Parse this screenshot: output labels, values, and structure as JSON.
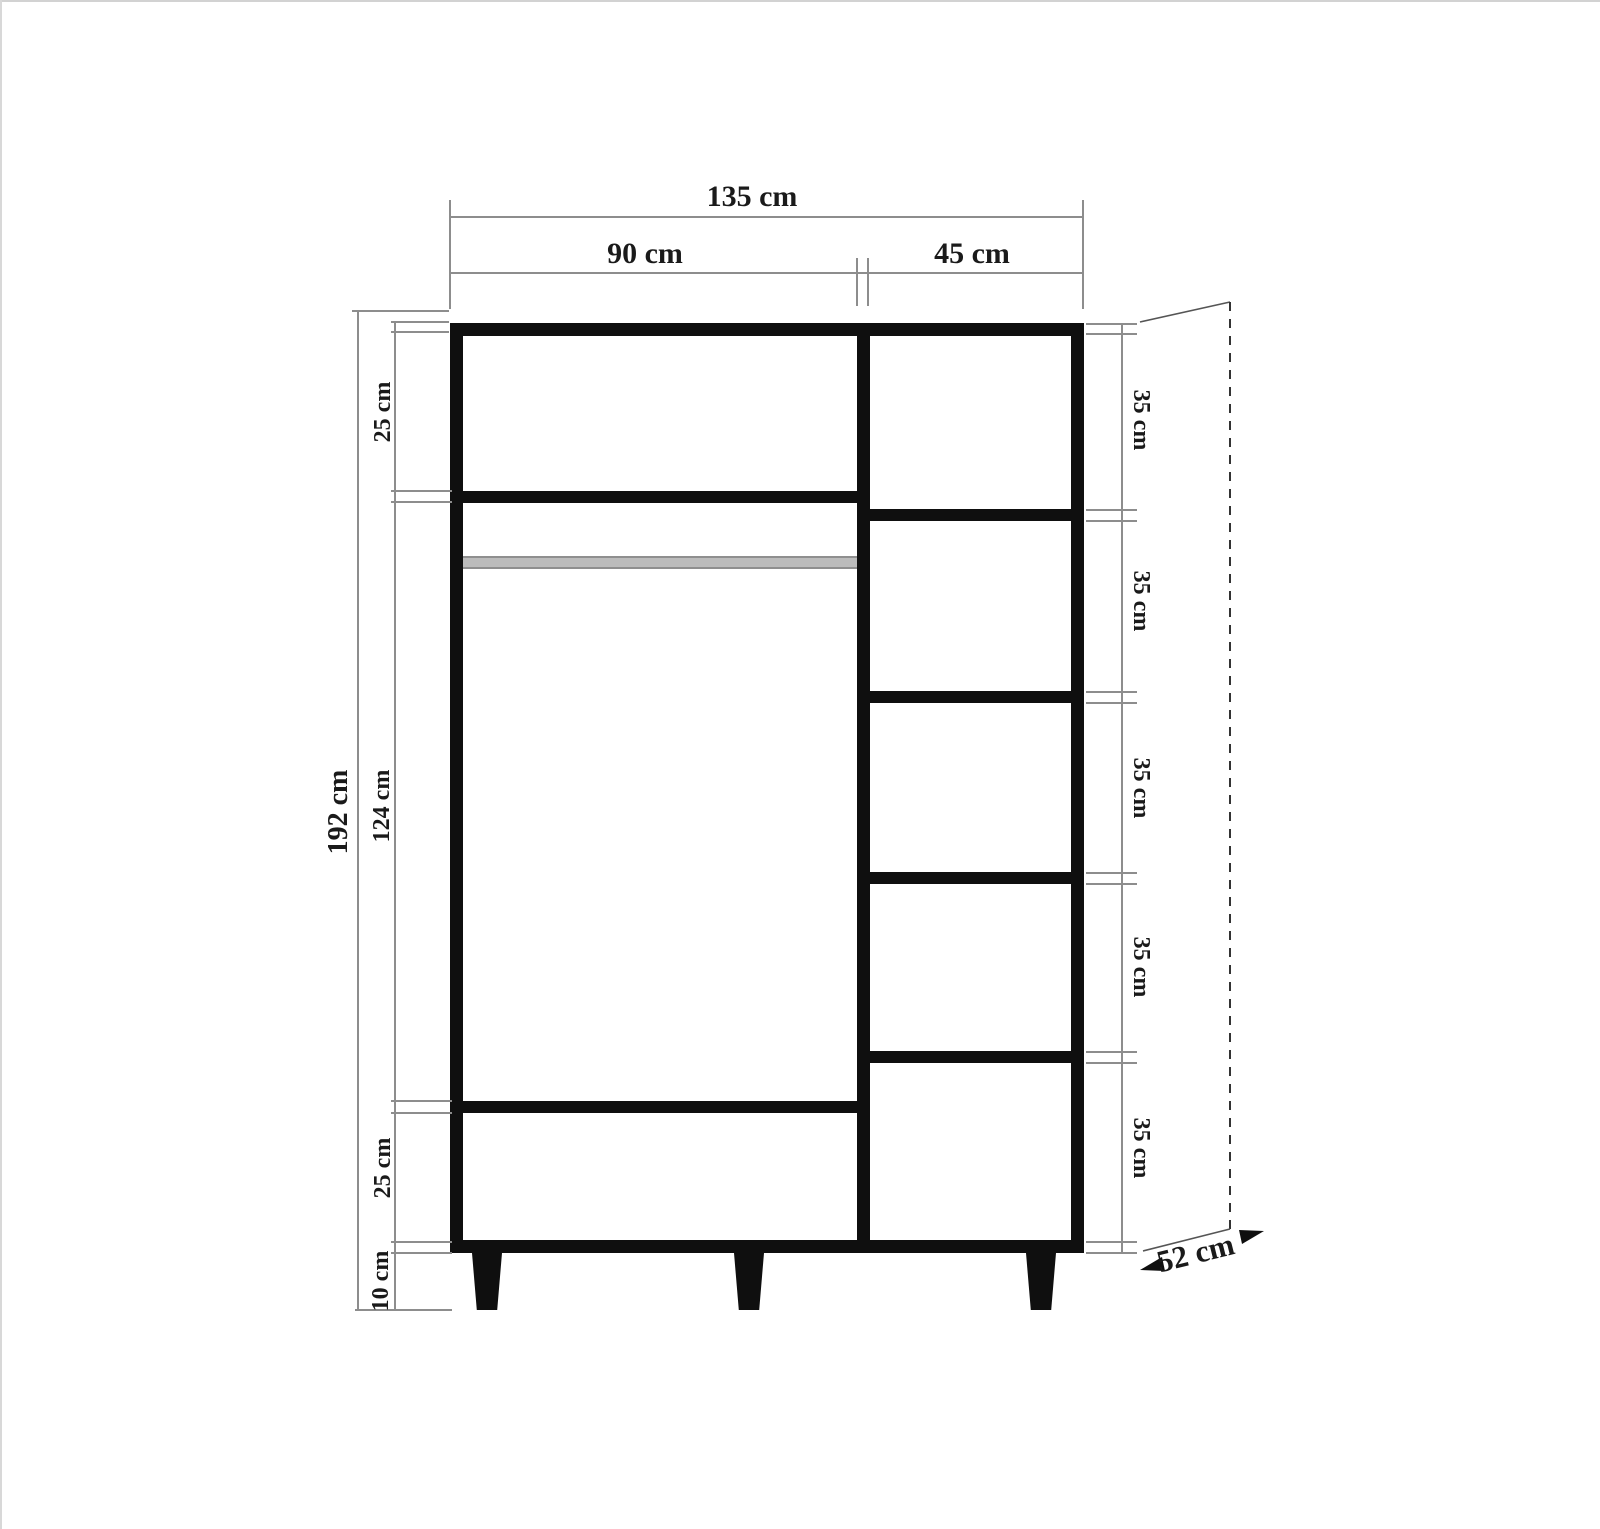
{
  "diagram": {
    "type": "wardrobe dimension drawing",
    "colors": {
      "background": "#ffffff",
      "cabinet_line": "#0f0f0f",
      "dimension_line": "#8d8d8d",
      "hanging_rod": "#bcbcbc",
      "text": "#1a1a1a"
    }
  },
  "dims": {
    "total_width": "135 cm",
    "left_width": "90 cm",
    "right_width": "45 cm",
    "total_height": "192 cm",
    "left_top": "25 cm",
    "left_middle": "124 cm",
    "left_bottom": "25 cm",
    "legs": "10 cm",
    "shelves": [
      "35 cm",
      "35 cm",
      "35 cm",
      "35 cm",
      "35 cm"
    ],
    "depth": "52 cm"
  }
}
